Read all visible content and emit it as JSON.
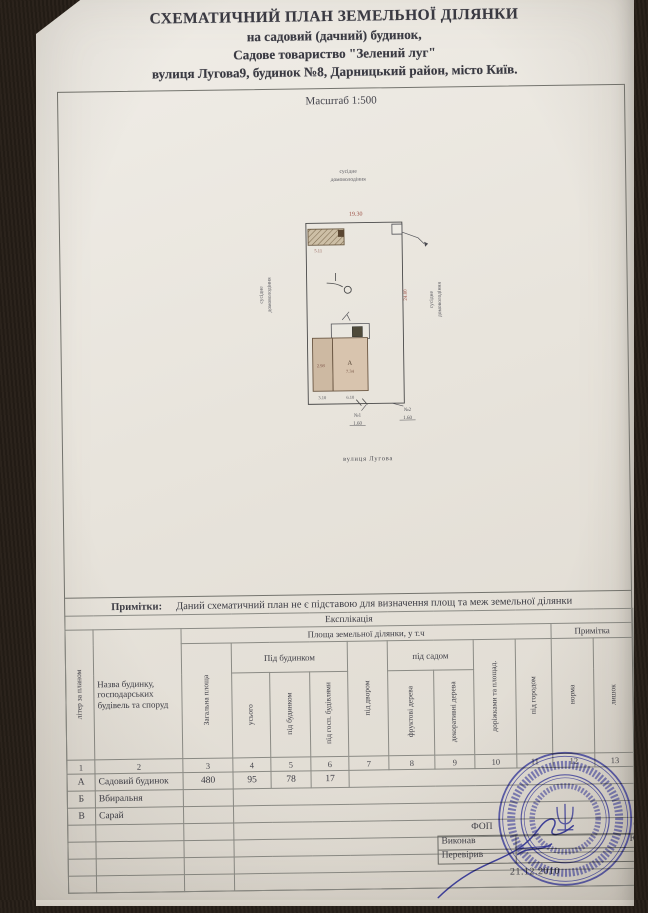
{
  "document": {
    "title_line1": "СХЕМАТИЧНИЙ ПЛАН ЗЕМЕЛЬНОЇ ДІЛЯНКИ",
    "title_line2": "на садовий (дачний)  будинок,",
    "title_line3": "Садове товариство \"Зелений луг\"",
    "title_line4": "вулиця Лугова9, будинок №8, Дарницький район, місто Київ.",
    "scale_label": "Масштаб 1:500"
  },
  "plan": {
    "neighbor_line1": "сусідне",
    "neighbor_line2": "домоволодіння",
    "dim_top": "19.30",
    "dim_right": "24.80",
    "shed_dim": "5.11",
    "annex_dim": "2.98",
    "house_letter": "А",
    "house_dim": "7.34",
    "dim_bottom_left": "3.10",
    "dim_bottom_right": "6.10",
    "gate1_no": "№1",
    "gate1_dim": "1.60",
    "gate2_no": "№2",
    "gate2_dim": "1.60",
    "street": "вулиця Лугова"
  },
  "notes": {
    "label": "Примітки:",
    "text": "Даний схематичний план не є підставою для визначення площ та меж земельної ділянки"
  },
  "table": {
    "caption": "Експлікація",
    "group_area": "Площа земельної ділянки, у т.ч",
    "group_note": "Примітка",
    "col_letter": "літер за планом",
    "col_name": "Назва будинку, господарських будівель та споруд",
    "col_total_area": "Загальна площа",
    "group_under_building": "Під будинком",
    "col_total": "усього",
    "col_under_house": "під будинком",
    "col_under_outbuildings": "під госп. будівлями",
    "col_yard": "під двором",
    "group_under_garden": "під садом",
    "col_fruit_trees": "фруктові дерева",
    "col_decorative_trees": "декоративні дерева",
    "col_paths": "доріжками та площад.",
    "col_vegetable_garden": "під городом",
    "col_norm": "норма",
    "col_surplus": "лишок",
    "numbering": [
      "1",
      "2",
      "3",
      "4",
      "5",
      "6",
      "7",
      "8",
      "9",
      "10",
      "11",
      "12",
      "13"
    ],
    "rows": [
      {
        "letter": "А",
        "name": "Садовий будинок",
        "total_area": "480",
        "total": "95",
        "under_house": "78",
        "under_outbuildings": "17"
      },
      {
        "letter": "Б",
        "name": "Вбиральня",
        "total_area": "",
        "total": "",
        "under_house": "",
        "under_outbuildings": ""
      },
      {
        "letter": "В",
        "name": "Сарай",
        "total_area": "",
        "total": "",
        "under_house": "",
        "under_outbuildings": ""
      }
    ]
  },
  "signoff": {
    "fop_fragment": "ФОП",
    "fop_name_fragment": "О.В.",
    "executed_label": "Виконав",
    "executed_name_fragment": "Ю.В.",
    "checked_label": "Перевірив",
    "checked_name_fragment": "",
    "date": "21.12.2010"
  },
  "colors": {
    "paper": "#eae6df",
    "ink": "#3a3a42",
    "dimension_red": "#9b4f44",
    "stamp_blue": "#3f42a3",
    "building_fill": "#d8c4ae"
  }
}
